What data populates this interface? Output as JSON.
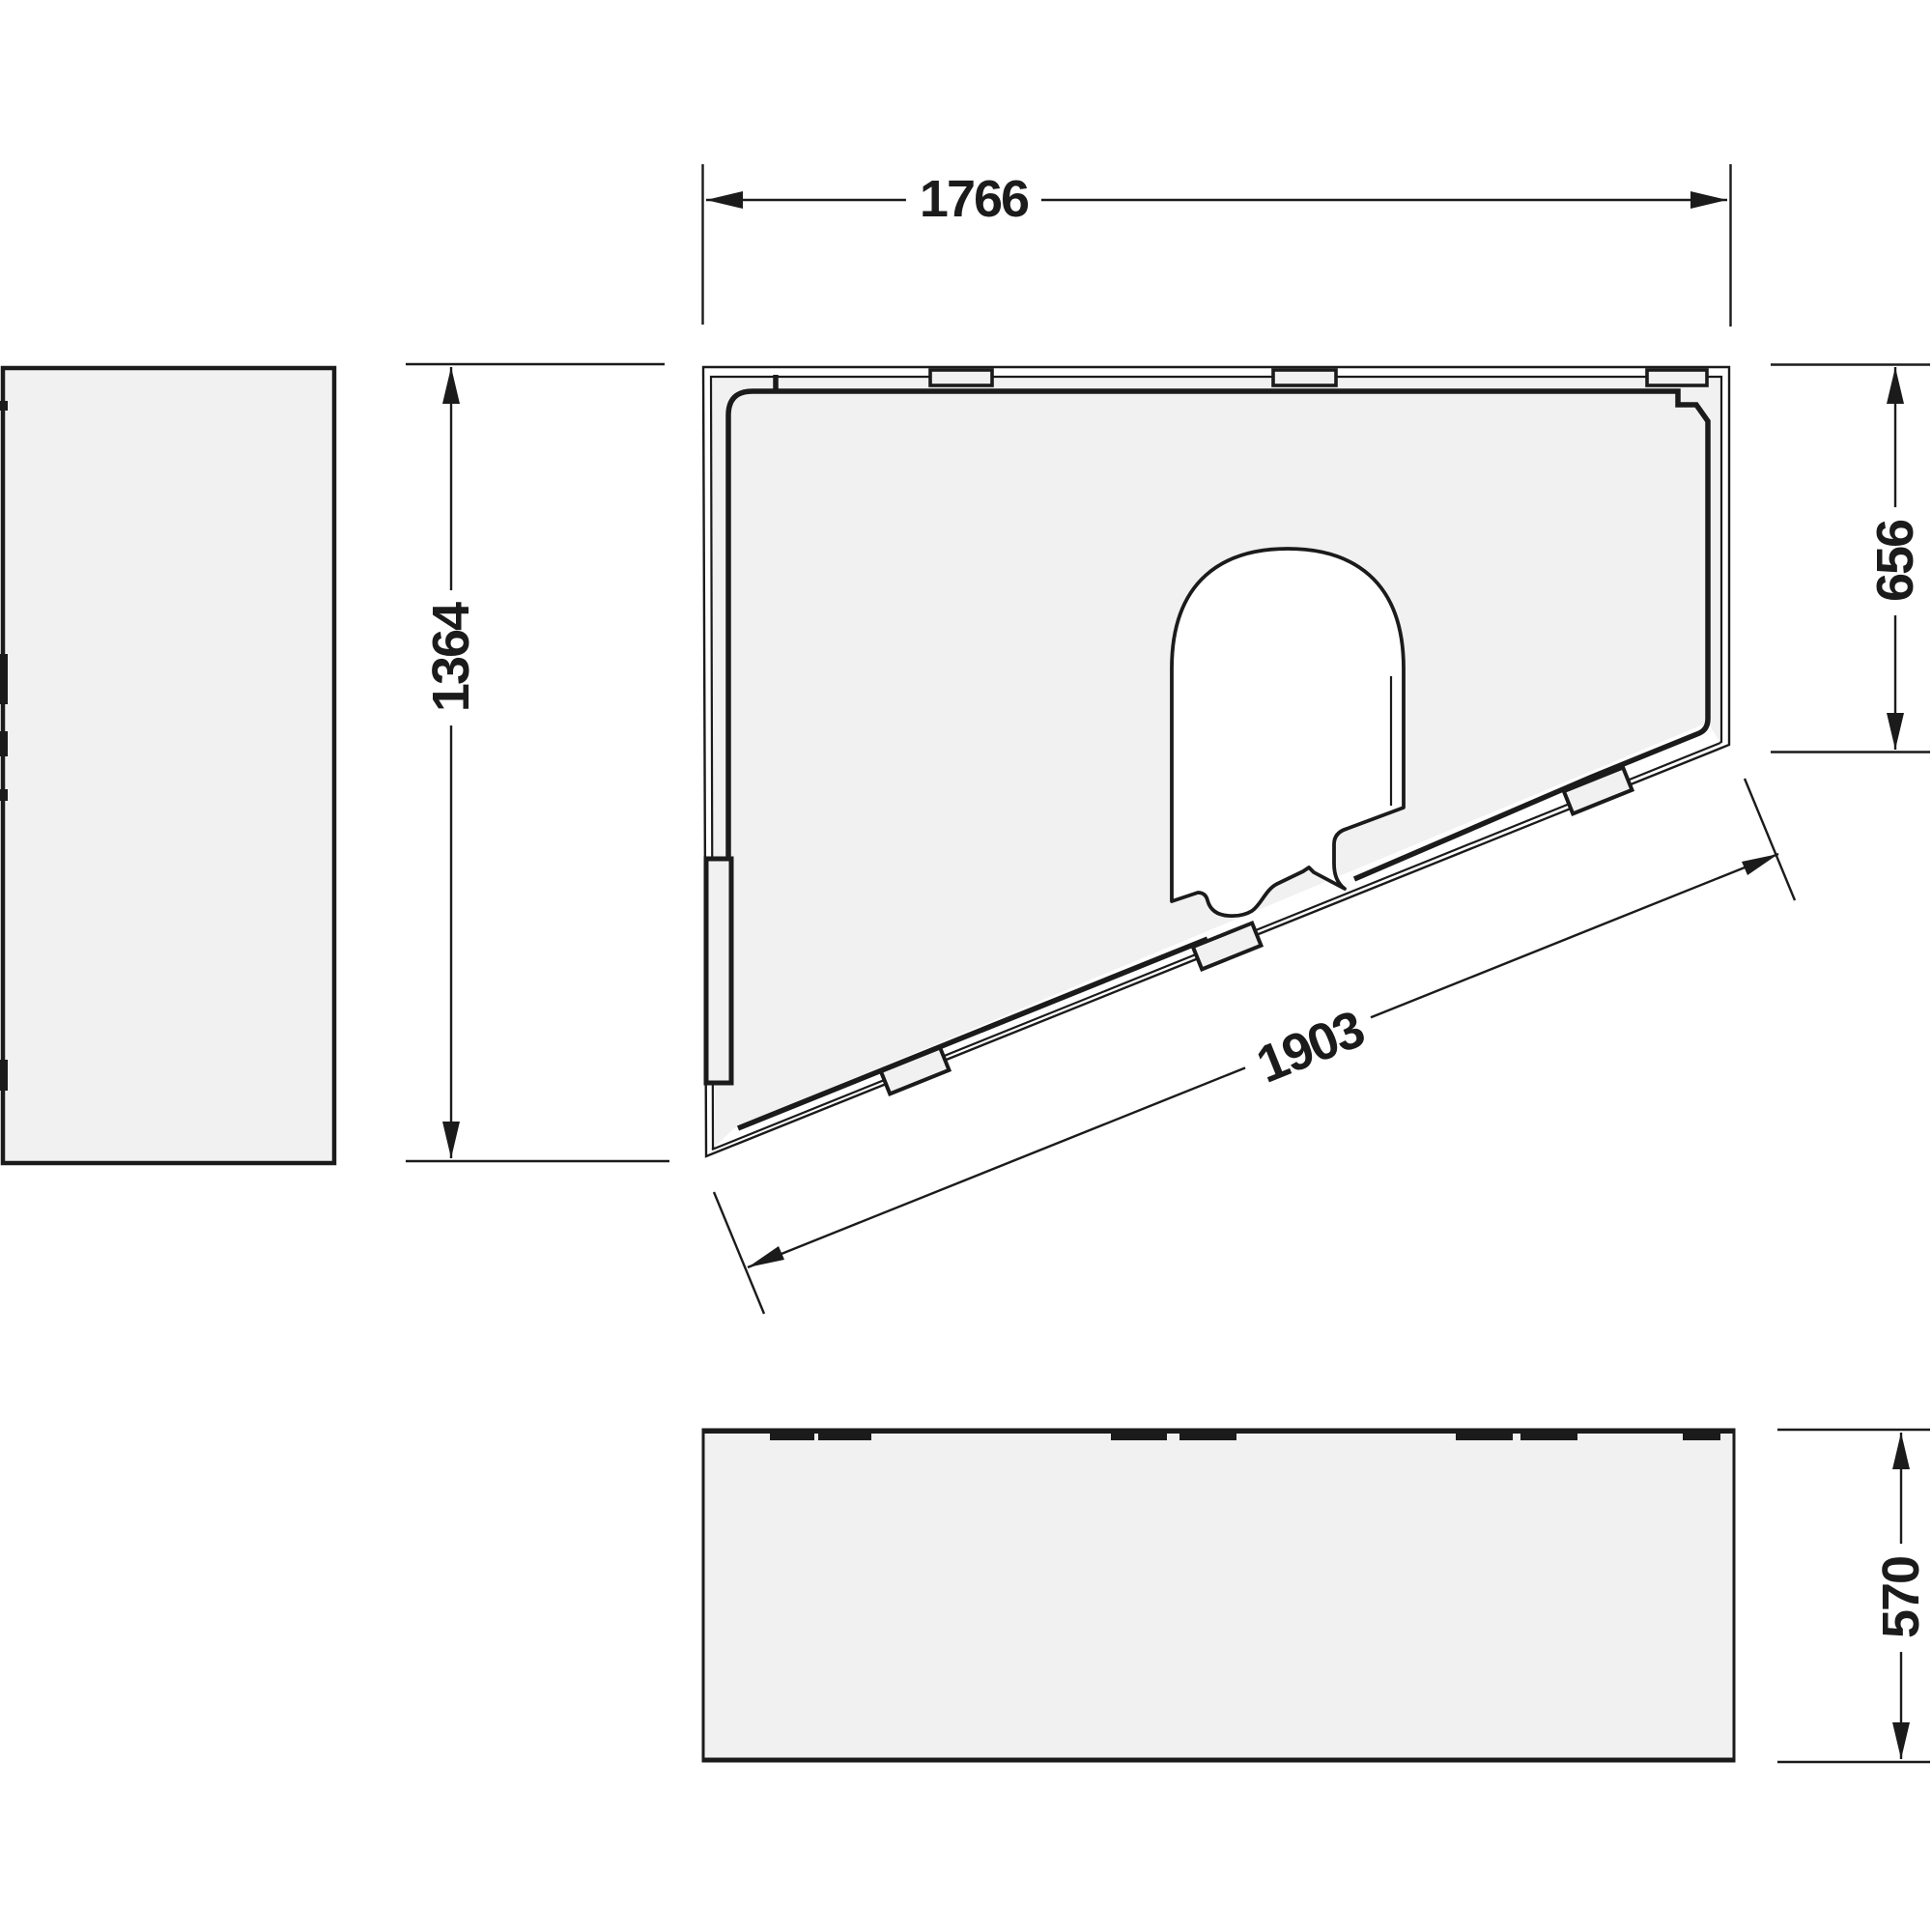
{
  "drawing": {
    "dimensions": {
      "top_width_mm": "1766",
      "left_height_mm": "1364",
      "right_height_mm": "656",
      "diagonal_length_mm": "1903",
      "depth_mm": "570"
    },
    "colors": {
      "line": "#1b1b1b",
      "panel_fill": "#f1f1f2",
      "cutout_fill": "#ffffff",
      "background": "#ffffff"
    }
  }
}
